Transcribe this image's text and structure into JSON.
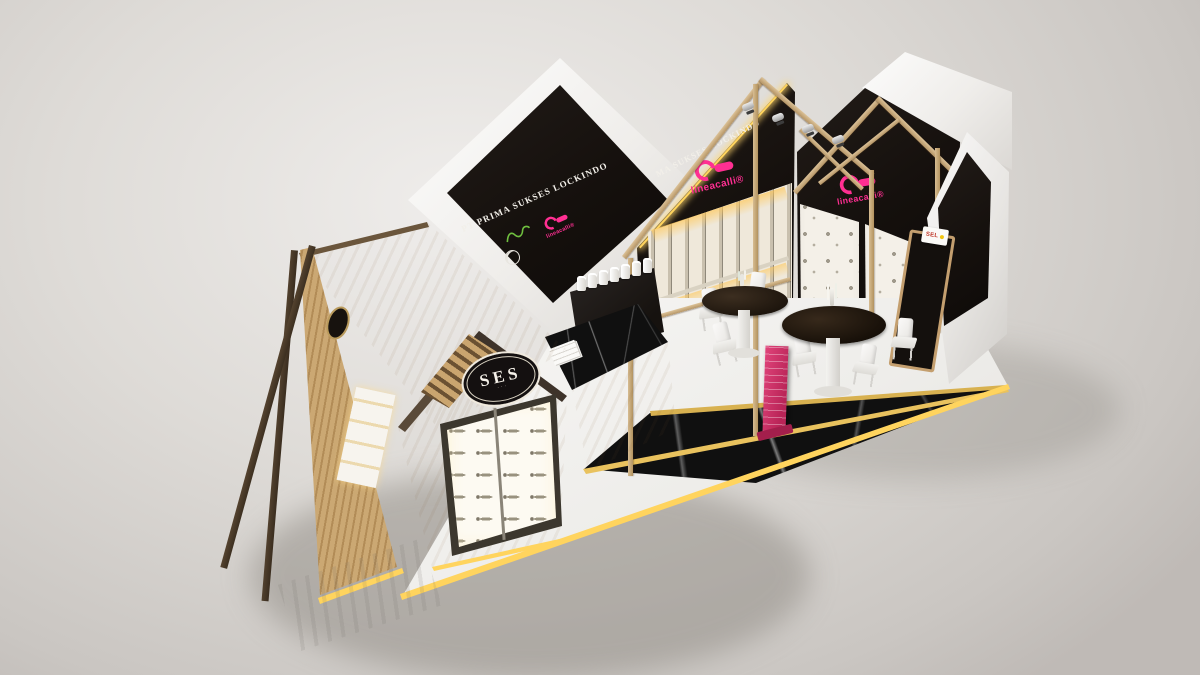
{
  "scene": {
    "type": "3d-booth-render",
    "description": "Isometric render of an exhibition booth with house-shaped wooden displays for door hardware",
    "background_color": "#dedbd7"
  },
  "branding": {
    "company_full": "PT PRIMA SUKSES LOCKINDO",
    "banner_visible": "MA SUKSES LOCKINDO",
    "lineacalli": {
      "name": "lineacalli",
      "reg_mark": "®",
      "color": "#ff2f92"
    },
    "ses": {
      "name": "SES",
      "sub": "···"
    },
    "side_sign": {
      "text": "SEL"
    }
  },
  "palette": {
    "wood_light": "#dcc094",
    "wood_mid": "#c8a271",
    "wood_beam_dark": "#4a3a2a",
    "panel_black": "#171310",
    "accent_pink": "#ff2f92",
    "led_yellow": "#ffd45e",
    "gold_trim": "#d8b150",
    "floor_white": "#f2f1ee",
    "marble_black": "#101010",
    "logo_green": "#6fbf3f"
  },
  "displays": {
    "front_handle_panel": {
      "columns": 2,
      "rows": 6,
      "item": "lever-handle"
    },
    "pull_handle_wall": {
      "rows": 2,
      "item": "vertical-pull-handle"
    },
    "knob_wall": {
      "panels": 2,
      "item": "door-knob"
    },
    "counter_samples": {
      "count": 7,
      "item": "white-cylinder"
    }
  },
  "furniture": {
    "round_tables": 2,
    "white_chairs": 6,
    "totem_color": "#d6336c",
    "reception": "black marble desk on wood base"
  }
}
